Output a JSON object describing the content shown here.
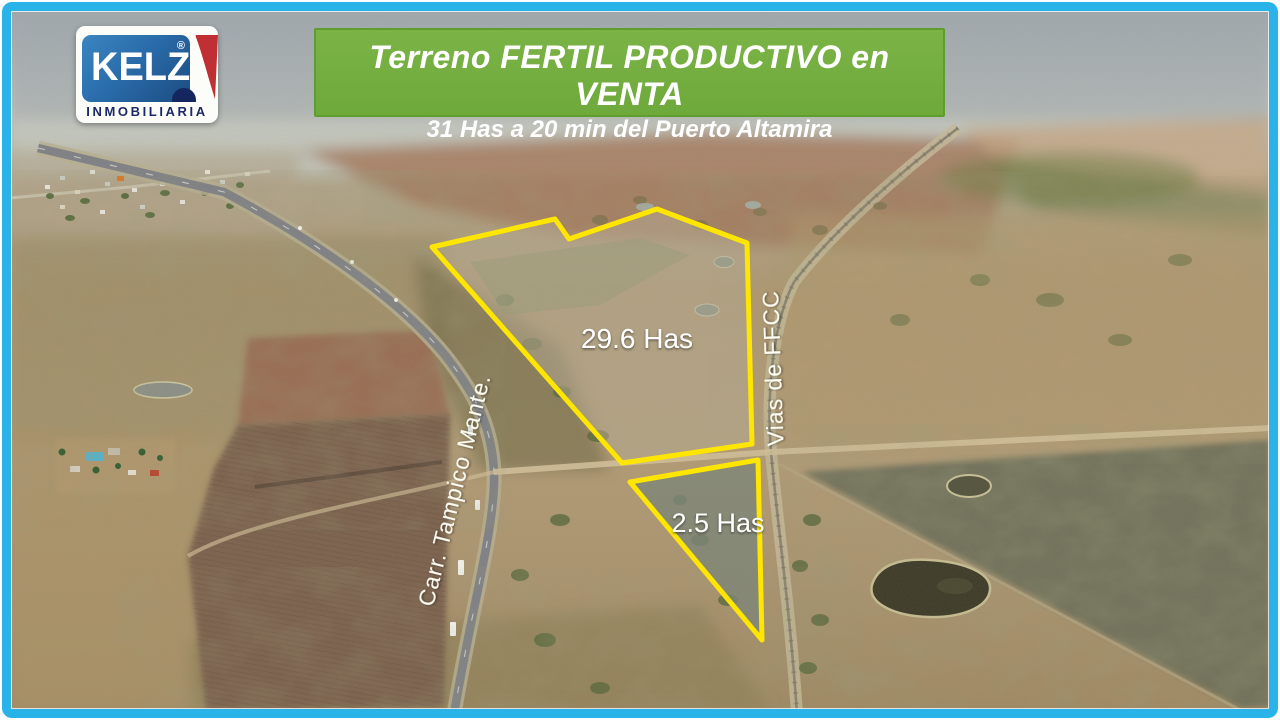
{
  "logo": {
    "brand": "KELZ",
    "registered_mark": "®",
    "subtitle": "INMOBILIARIA",
    "colors": {
      "blue": "#2a6cab",
      "red": "#bf2f34",
      "navy": "#15265e"
    }
  },
  "banner": {
    "title": "Terreno FERTIL PRODUCTIVO en VENTA",
    "subtitle": "31 Has a 20 min del Puerto Altamira",
    "bg_color": "#6ea93b"
  },
  "map": {
    "parcels": [
      {
        "label": "29.6 Has",
        "outline_color": "#ffe600"
      },
      {
        "label": "2.5 Has",
        "outline_color": "#ffe600"
      }
    ],
    "road_labels": [
      {
        "label": "Carr. Tampico Mante."
      },
      {
        "label": "Vias de FFCC"
      }
    ]
  },
  "frame": {
    "border_color": "#29b3e8"
  }
}
